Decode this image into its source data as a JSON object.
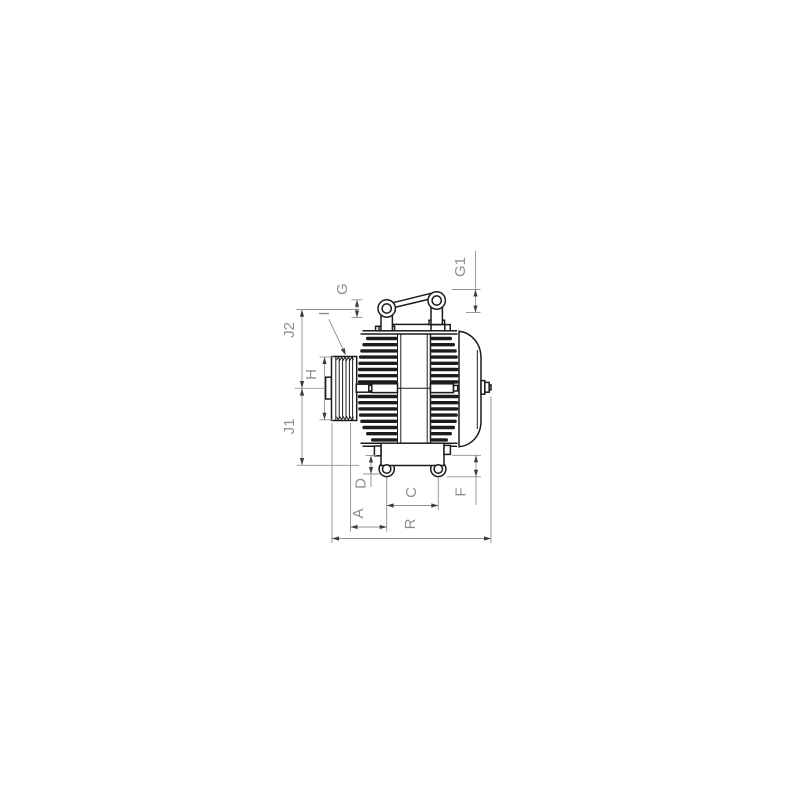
{
  "page": {
    "background": "#ffffff"
  },
  "drawing": {
    "kind": "technical-dimension-drawing",
    "subject": "alternator-side-view",
    "colors": {
      "line": "#1c1c1c",
      "dimension_line": "#909090",
      "arrowhead": "#3d3d3d",
      "label": "#8f8f8f",
      "background": "#ffffff"
    },
    "dimension_labels": {
      "j2": "J2",
      "j1": "J1",
      "h": "H",
      "i": "I",
      "g": "G",
      "g1": "G1",
      "d": "D",
      "c": "C",
      "f": "F",
      "a": "A",
      "r": "R"
    }
  }
}
